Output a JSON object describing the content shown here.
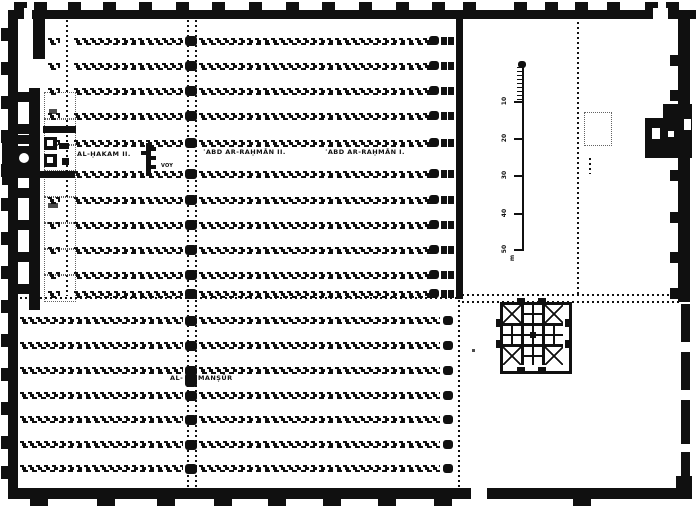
{
  "labels": {
    "al_hakam_ii": "AL-ḤAKAM II.",
    "abd_ar_rahman_ii": "ʿABD AR-RAḤMĀN II.",
    "abd_ar_rahman_i": "ʿABD AR-RAḤMĀN I.",
    "al_mansur_prefix": "AL-",
    "al_mansur_suffix": "MANṢŪR",
    "tiny_annotation": "VOY"
  },
  "scale_bar": {
    "tick_labels": [
      "10",
      "20",
      "30",
      "40",
      "50"
    ],
    "unit_label": "m"
  },
  "colors": {
    "ink": "#101010",
    "paper": "#ffffff"
  },
  "geometry": {
    "walls": [
      [
        8,
        10,
        688,
        9
      ],
      [
        8,
        10,
        10,
        489
      ],
      [
        8,
        488,
        670,
        11
      ],
      [
        678,
        12,
        12,
        290
      ],
      [
        456,
        18,
        7,
        281
      ],
      [
        29,
        88,
        11,
        222
      ],
      [
        33,
        19,
        12,
        40
      ],
      [
        676,
        476,
        16,
        23
      ]
    ],
    "white_gaps": [
      [
        24,
        8,
        8,
        13
      ],
      [
        653,
        8,
        15,
        13
      ],
      [
        471,
        486,
        16,
        14
      ]
    ],
    "buttresses_top": {
      "y": 2,
      "w": 13,
      "h": 9,
      "xs": [
        14,
        34,
        68,
        103,
        139,
        176,
        212,
        249,
        286,
        322,
        359,
        396,
        432,
        463,
        514,
        545,
        575,
        607,
        645,
        666
      ]
    },
    "buttresses_left": {
      "x": 1,
      "w": 7,
      "h": 13,
      "ys": [
        28,
        62,
        96,
        130,
        164,
        198,
        232,
        266,
        300,
        334,
        368,
        402,
        436,
        466
      ]
    },
    "buttresses_bottom": {
      "y": 497,
      "w": 18,
      "h": 9,
      "xs": [
        30,
        97,
        157,
        214,
        268,
        323,
        378,
        434,
        573
      ]
    },
    "buttresses_right": {
      "x": 670,
      "w": 9,
      "h": 11,
      "ys": [
        55,
        90,
        170,
        212,
        252,
        288
      ]
    },
    "right_wall_dashes": {
      "x": 681,
      "w": 9,
      "segs": [
        [
          304,
          38
        ],
        [
          352,
          38
        ],
        [
          400,
          44
        ],
        [
          452,
          26
        ]
      ]
    },
    "crossbars": {
      "x": 17,
      "w": 13,
      "h": 10,
      "ys": [
        92,
        124,
        188,
        220,
        252,
        284
      ]
    },
    "bay_boxes": {
      "x": 44,
      "w": 30,
      "h": 26,
      "ys": [
        92,
        118,
        144,
        170,
        196,
        222,
        248,
        274
      ]
    },
    "strips_top": {
      "h": 7,
      "ys": [
        38,
        63,
        88,
        113,
        140,
        171,
        197,
        222,
        247,
        272,
        291
      ],
      "segments": [
        [
          48,
          60
        ],
        [
          74,
          183
        ],
        [
          199,
          432
        ]
      ]
    },
    "strips_bottom": {
      "h": 7,
      "ys": [
        317,
        342,
        367,
        392,
        416,
        441,
        465
      ],
      "segments": [
        [
          20,
          183
        ],
        [
          199,
          440
        ]
      ]
    },
    "line_a": {
      "x": 66,
      "y": 20,
      "h": 276
    },
    "line_b": {
      "x1": 187,
      "x2": 195,
      "y": 20,
      "h": 468,
      "dot_x": 185,
      "dot_w": 12,
      "dot_h": 10,
      "extra_dot": [
        185,
        373,
        12,
        14
      ]
    },
    "line_c": {
      "end_dot_x": 429,
      "bowtie_xs": [
        441,
        448
      ]
    },
    "line_d": {
      "dots_x": 443,
      "dot_w": 10,
      "dot_h": 9,
      "vdots_x": 458,
      "y": 300,
      "h": 188
    },
    "boundary": {
      "single": [
        20,
        297,
        436
      ],
      "double": [
        [
          462,
          294,
          218
        ],
        [
          462,
          301,
          218
        ]
      ]
    },
    "courtyard_dots": {
      "vline": [
        577,
        22,
        274
      ],
      "old_minaret_box": [
        584,
        112,
        26,
        32
      ],
      "small_col": [
        589,
        158,
        2,
        16
      ]
    },
    "scale_bar": {
      "line": [
        522,
        64,
        2,
        187
      ],
      "top_dot": [
        518,
        61,
        8,
        7
      ],
      "minor_ticks": {
        "x": 517,
        "w": 5,
        "ys": [
          67,
          71,
          75,
          79,
          83,
          87,
          91,
          95,
          99
        ]
      },
      "major_ticks": {
        "x": 514,
        "w": 8,
        "ys": [
          101,
          138,
          175,
          213,
          249
        ]
      },
      "label_x": 497,
      "unit_pos": [
        505,
        251
      ]
    },
    "minaret": {
      "rect": [
        645,
        104,
        47,
        54
      ],
      "trim": [
        645,
        104,
        18,
        14
      ],
      "notches": [
        [
          652,
          128,
          8,
          11
        ],
        [
          668,
          131,
          6,
          6
        ],
        [
          684,
          119,
          7,
          11
        ]
      ]
    },
    "mihrab": {
      "blacks": [
        [
          2,
          133,
          13,
          52
        ],
        [
          14,
          146,
          17,
          24
        ],
        [
          16,
          135,
          21,
          9
        ],
        [
          16,
          169,
          21,
          9
        ],
        [
          43,
          126,
          33,
          7
        ],
        [
          40,
          171,
          35,
          7
        ],
        [
          44,
          137,
          13,
          13
        ],
        [
          44,
          154,
          13,
          13
        ],
        [
          59,
          143,
          10,
          6
        ],
        [
          62,
          158,
          7,
          7
        ]
      ],
      "circle": [
        19,
        153,
        10,
        10
      ],
      "whites": [
        [
          47,
          140,
          6,
          6
        ],
        [
          47,
          157,
          6,
          6
        ]
      ]
    },
    "transept": {
      "bar": [
        146,
        143,
        5,
        33
      ],
      "ticks": [
        [
          151,
          147,
          5,
          4
        ],
        [
          151,
          156,
          5,
          4
        ],
        [
          151,
          165,
          5,
          4
        ],
        [
          141,
          151,
          5,
          4
        ]
      ]
    },
    "fountain": {
      "x": 500,
      "y": 302,
      "size": 66,
      "pattern": [
        [
          "x",
          "p",
          "x"
        ],
        [
          "p",
          "c",
          "p"
        ],
        [
          "x",
          "p",
          "x"
        ]
      ]
    },
    "noise": [
      [
        49,
        109,
        8,
        5
      ],
      [
        48,
        203,
        10,
        5
      ],
      [
        472,
        349,
        3,
        3
      ]
    ],
    "label_pos": {
      "al_hakam_ii": [
        77,
        150
      ],
      "abd_ar_rahman_ii": [
        203,
        148
      ],
      "abd_ar_rahman_i": [
        325,
        148
      ],
      "al_mansur_prefix": [
        170,
        374
      ],
      "al_mansur_suffix": [
        198,
        374
      ],
      "tiny_annotation": [
        161,
        163
      ]
    }
  }
}
